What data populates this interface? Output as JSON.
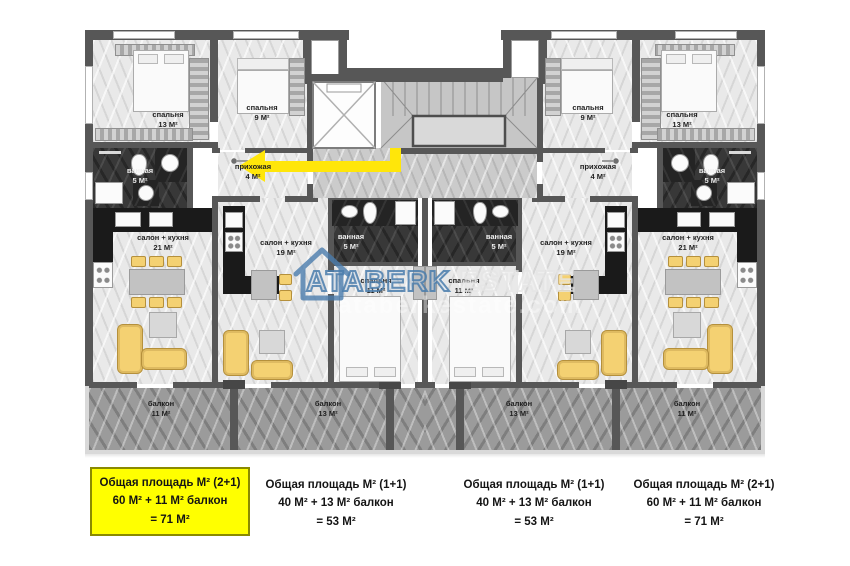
{
  "watermark": {
    "brand": "ATABERK",
    "brand2": "ESTATE",
    "ghost": "ataberkestate.com"
  },
  "rooms": [
    {
      "name": "спальня",
      "area": "13 М²"
    },
    {
      "name": "спальня",
      "area": "9 М²"
    },
    {
      "name": "ванная",
      "area": "5 М²"
    },
    {
      "name": "прихожая",
      "area": "4 М²"
    },
    {
      "name": "салон + кухня",
      "area": "21 М²"
    },
    {
      "name": "салон + кухня",
      "area": "19 М²"
    },
    {
      "name": "ванная",
      "area": "5 М²"
    },
    {
      "name": "спальня",
      "area": "11 М²"
    },
    {
      "name": "спальня",
      "area": "11 М²"
    },
    {
      "name": "ванная",
      "area": "5 М²"
    },
    {
      "name": "салон + кухня",
      "area": "19 М²"
    },
    {
      "name": "салон + кухня",
      "area": "21 М²"
    },
    {
      "name": "прихожая",
      "area": "4 М²"
    },
    {
      "name": "ванная",
      "area": "5 М²"
    },
    {
      "name": "спальня",
      "area": "9 М²"
    },
    {
      "name": "спальня",
      "area": "13 М²"
    },
    {
      "name": "балкон",
      "area": "11 М²"
    },
    {
      "name": "балкон",
      "area": "13 М²"
    },
    {
      "name": "балкон",
      "area": "13 М²"
    },
    {
      "name": "балкон",
      "area": "11 М²"
    }
  ],
  "summaries": [
    {
      "line1": "Общая площадь М² (2+1)",
      "line2": "60 М² + 11 М² балкон",
      "line3": "= 71 М²"
    },
    {
      "line1": "Общая площадь М² (1+1)",
      "line2": "40 М² + 13 М² балкон",
      "line3": "= 53 М²"
    },
    {
      "line1": "Общая площадь М² (1+1)",
      "line2": "40 М² + 13 М² балкон",
      "line3": "= 53 М²"
    },
    {
      "line1": "Общая площадь М² (2+1)",
      "line2": "60 М² + 11 М² балкон",
      "line3": "= 71 М²"
    }
  ],
  "colors": {
    "highlight_box_yellow": "#ffff00",
    "furniture_yellow": "#f4d172",
    "route_arrow_yellow": "#ffe60a",
    "watermark_blue": "#4a7cac",
    "wall_gray": "#575757"
  }
}
